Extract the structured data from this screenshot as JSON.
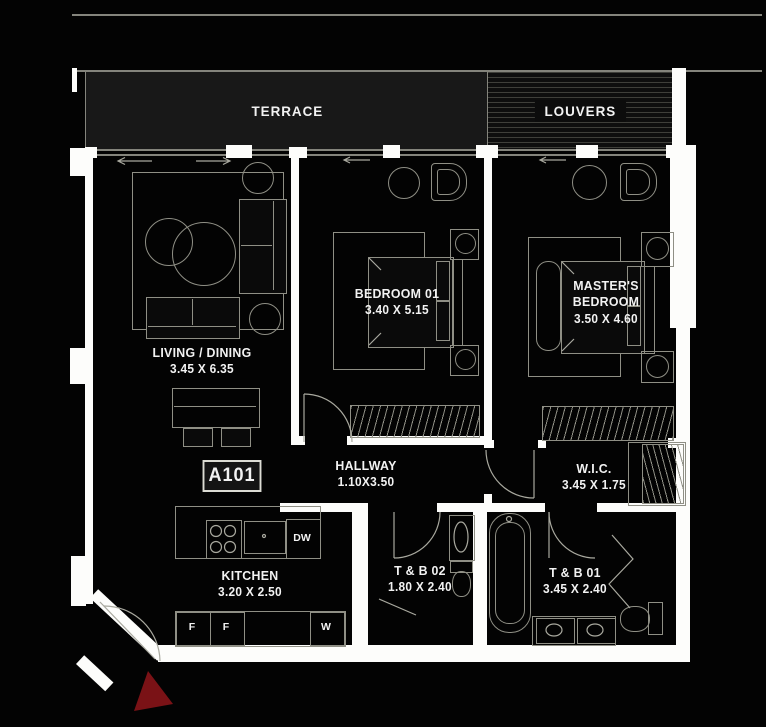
{
  "unit": {
    "label": "A101"
  },
  "bands": {
    "terrace": "TERRACE",
    "louvers": "LOUVERS"
  },
  "rooms": {
    "living": {
      "name": "LIVING / DINING",
      "dims": "3.45 X 6.35"
    },
    "bedroom1": {
      "name": "BEDROOM 01",
      "dims": "3.40 X 5.15"
    },
    "master": {
      "name": "MASTER'S BEDROOM",
      "dims": "3.50 X 4.60"
    },
    "hallway": {
      "name": "HALLWAY",
      "dims": "1.10X3.50"
    },
    "wic": {
      "name": "W.I.C.",
      "dims": "3.45 X 1.75"
    },
    "kitchen": {
      "name": "KITCHEN",
      "dims": "3.20 X 2.50"
    },
    "tb02": {
      "name": "T & B 02",
      "dims": "1.80 X 2.40"
    },
    "tb01": {
      "name": "T & B 01",
      "dims": "3.45 X 2.40"
    }
  },
  "appliances": {
    "dishwasher": "DW",
    "fridge_left": "F",
    "fridge_right": "F",
    "washer": "W"
  },
  "colors": {
    "background": "#030303",
    "floor": "#0a0a0a",
    "wall": "#fdfdfb",
    "line": "#8f8f85",
    "line_bright": "#c4c4ba",
    "text": "#f2f2f2",
    "accent": "#7a1216",
    "panel": "#181818",
    "edge": "#84847c"
  }
}
